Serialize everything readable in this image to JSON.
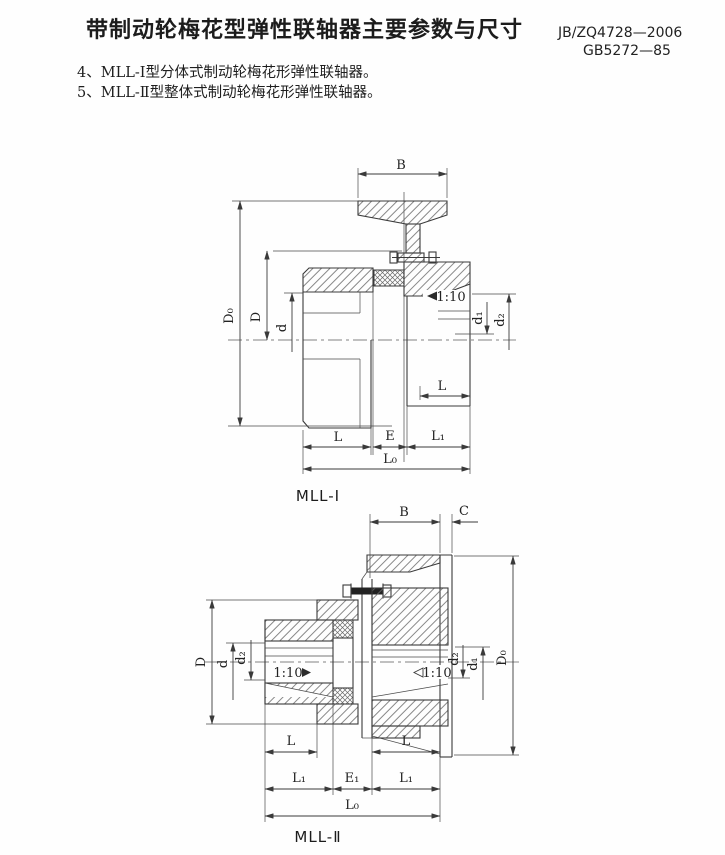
{
  "header": {
    "title": "带制动轮梅花型弹性联轴器主要参数与尺寸",
    "standard_1": "JB/ZQ4728—2006",
    "standard_2": "GB5272—85"
  },
  "notes": [
    "4、MLL-Ⅰ型分体式制动轮梅花形弹性联轴器。",
    "5、MLL-Ⅱ型整体式制动轮梅花形弹性联轴器。"
  ],
  "fig1": {
    "caption": "MLL-Ⅰ",
    "labels": {
      "B": "B",
      "D0": "D₀",
      "D": "D",
      "d": "d",
      "d1": "d₁",
      "d2": "d₂",
      "taper": "1:10",
      "L_hub": "L",
      "L": "L",
      "E": "E",
      "L1": "L₁",
      "L0": "L₀"
    }
  },
  "fig2": {
    "caption": "MLL-Ⅱ",
    "labels": {
      "B": "B",
      "C": "C",
      "D0": "D₀",
      "D": "D",
      "d": "d",
      "d2_left": "d₂",
      "d2_right": "d₂",
      "d1": "d₁",
      "taper_left": "1:10",
      "taper_right": "1:10",
      "L_left": "L",
      "L_right": "L",
      "L1_left": "L₁",
      "E1": "E₁",
      "L1_right": "L₁",
      "L0": "L₀"
    }
  },
  "colors": {
    "ink": "#3a3a3a",
    "paper": "#fefefe"
  }
}
